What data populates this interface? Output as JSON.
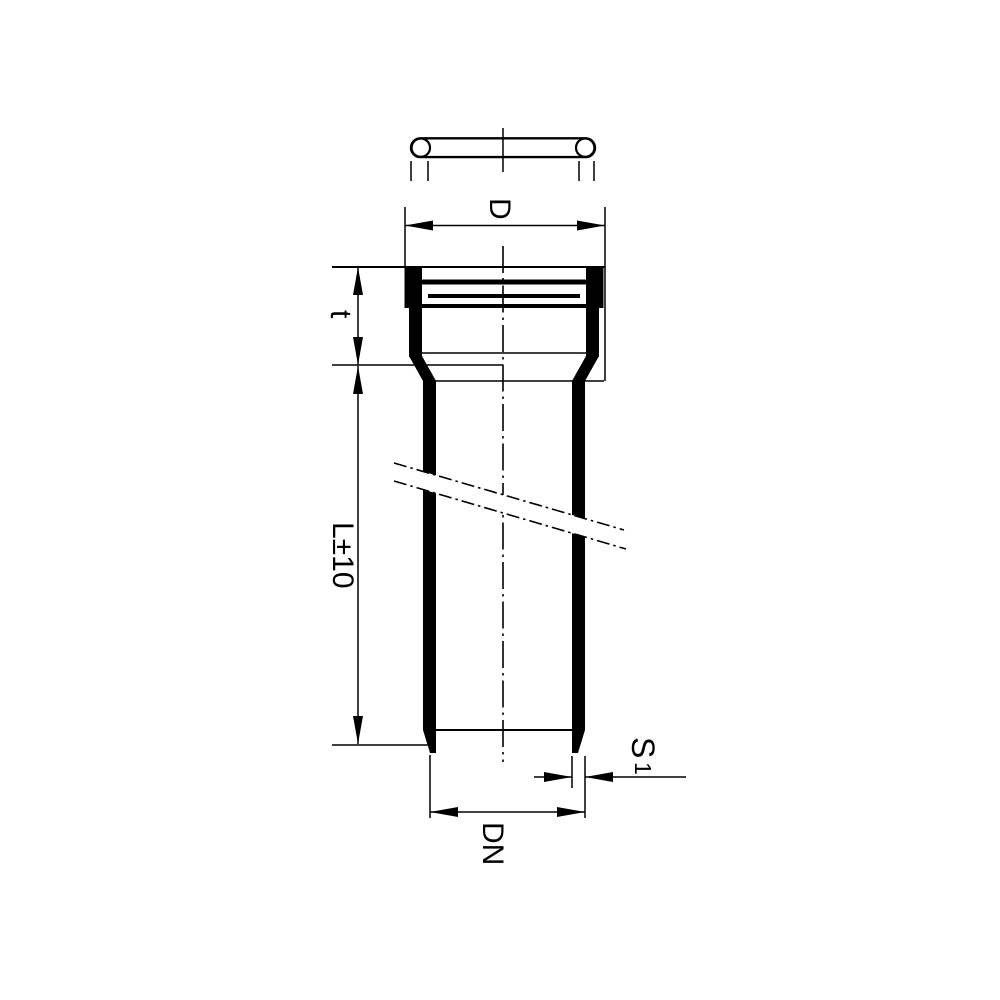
{
  "drawing": {
    "background_color": "#ffffff",
    "line_color": "#000000",
    "labels": {
      "socket_outer_diameter": "D",
      "socket_depth": "t",
      "pipe_length_tolerance": "L±10",
      "nominal_diameter": "DN",
      "wall_thickness_symbol": "S",
      "wall_thickness_subscript": "1"
    }
  }
}
